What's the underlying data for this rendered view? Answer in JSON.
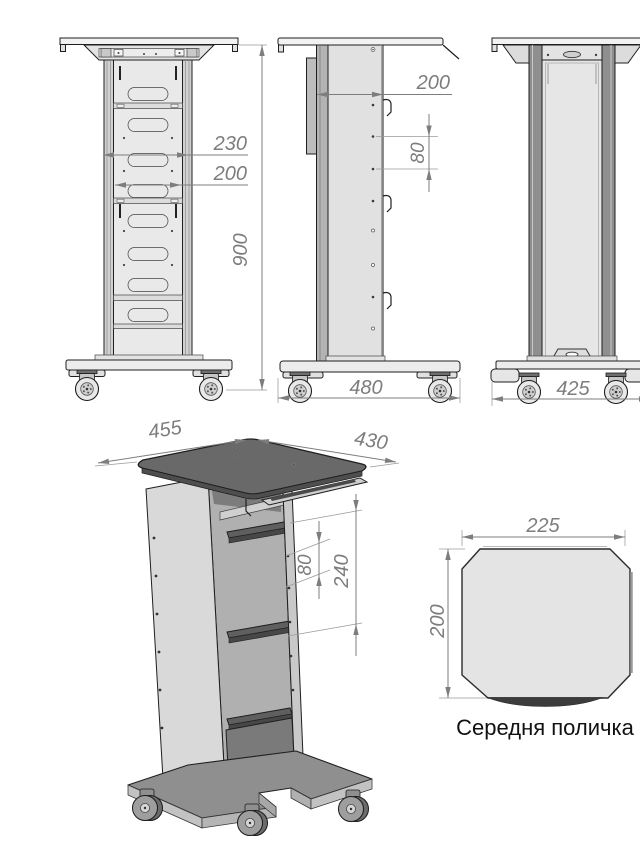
{
  "colors": {
    "outline": "#1f1f1f",
    "dimension": "#7d7d7d",
    "panel_light": "#e9e9e9",
    "panel_mid": "#c9c9c9",
    "rail_dark": "#8f8f8f",
    "iso_top_dark": "#696969",
    "shelf_fill": "#e4e4e4",
    "shelf_edge_dark": "#3c3c3c"
  },
  "views": {
    "front": {
      "dims": {
        "column_width_outer": "230",
        "column_width_inner": "200",
        "overall_height": "900"
      }
    },
    "side": {
      "dims": {
        "column_depth": "200",
        "hole_pitch": "80",
        "base_length": "480"
      }
    },
    "back": {
      "dims": {
        "base_width": "425"
      }
    },
    "isometric": {
      "dims": {
        "tabletop_depth": "455",
        "tabletop_width": "430",
        "shelf_hole_pitch": "80",
        "shelf_spacing": "240"
      }
    },
    "middle_shelf_detail": {
      "dims": {
        "width": "225",
        "depth": "200"
      },
      "caption": "Середня поличка"
    }
  }
}
